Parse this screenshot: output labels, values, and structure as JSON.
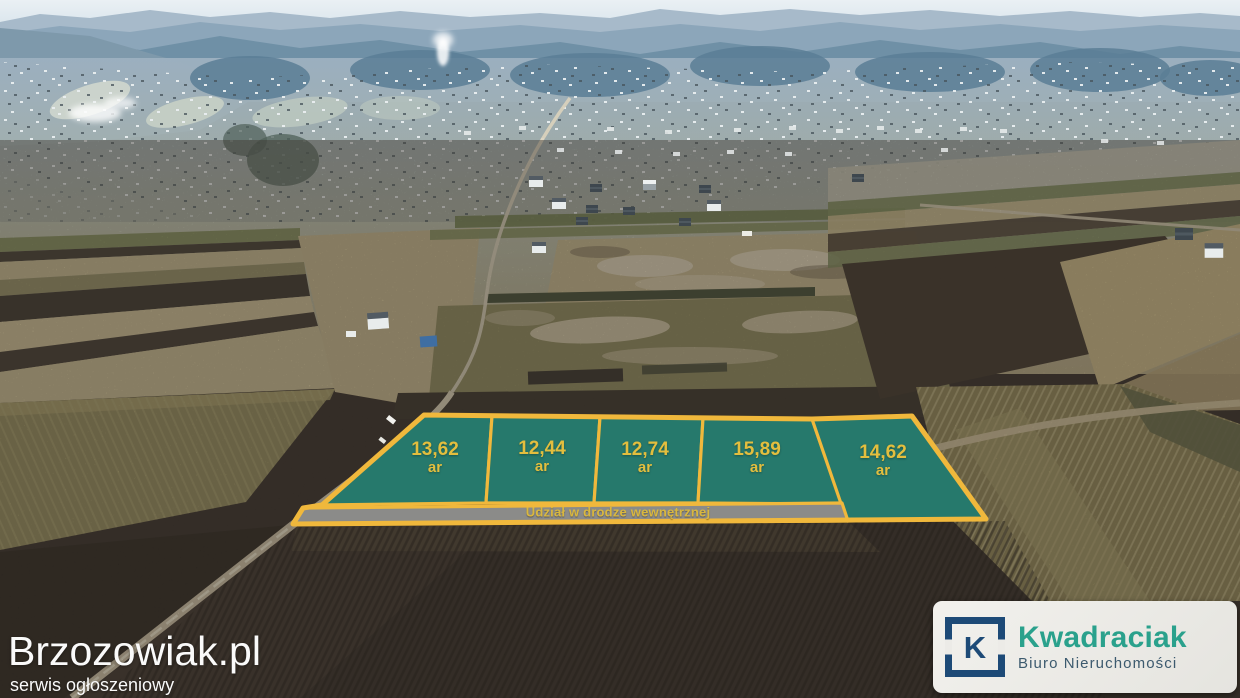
{
  "overlay": {
    "plots": [
      {
        "area": "13,62",
        "unit": "ar"
      },
      {
        "area": "12,44",
        "unit": "ar"
      },
      {
        "area": "12,74",
        "unit": "ar"
      },
      {
        "area": "15,89",
        "unit": "ar"
      },
      {
        "area": "14,62",
        "unit": "ar"
      }
    ],
    "road_label": "Udział w drodze wewnętrznej",
    "colors": {
      "plot_fill": "#26796C",
      "plot_border": "#F0B83C",
      "label_text": "#E3BE3E",
      "road_fill": "#8B8B89",
      "road_text": "#D9B73F"
    }
  },
  "watermark": {
    "site": "Brzozowiak.pl",
    "tagline": "serwis ogłoszeniowy"
  },
  "logo": {
    "icon_letter": "K",
    "brand": "Kwadraciak",
    "subtitle": "Biuro Nieruchomości",
    "colors": {
      "brand": "#2AA18C",
      "navy": "#1D4A77",
      "subtitle": "#3C5A6E",
      "card_bg": "#ECEBE7"
    }
  }
}
